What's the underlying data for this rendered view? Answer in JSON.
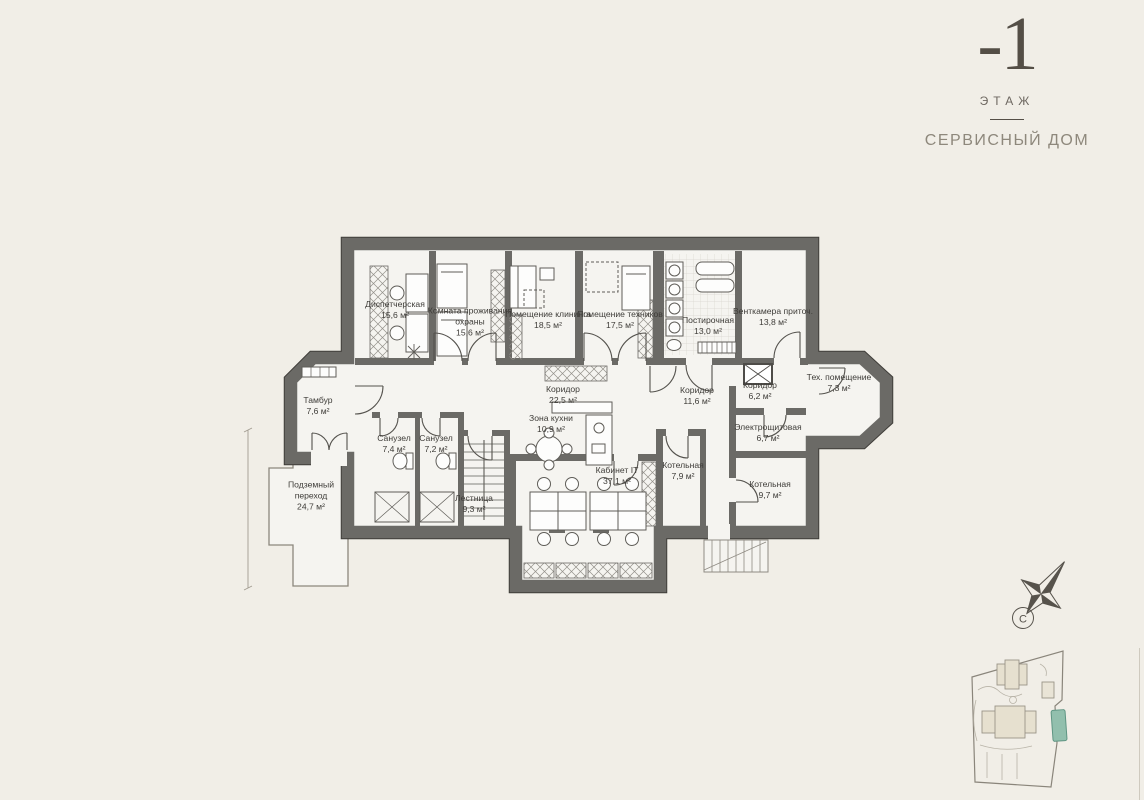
{
  "header": {
    "floor_number": "-1",
    "floor_label": "ЭТАЖ",
    "building_name": "СЕРВИСНЫЙ ДОМ"
  },
  "rooms": [
    {
      "name": "Диспетчерская",
      "area": "15,6 м²"
    },
    {
      "name": "Комната проживания охраны",
      "area": "15,6 м²"
    },
    {
      "name": "Помещение клининга",
      "area": "18,5 м²"
    },
    {
      "name": "Помещение техников",
      "area": "17,5 м²"
    },
    {
      "name": "Постирочная",
      "area": "13,0 м²"
    },
    {
      "name": "Венткамера приточ.",
      "area": "13,8 м²"
    },
    {
      "name": "Тамбур",
      "area": "7,6 м²"
    },
    {
      "name": "Коридор",
      "area": "22,5 м²"
    },
    {
      "name": "Зона кухни",
      "area": "10,9 м²"
    },
    {
      "name": "Коридор",
      "area": "11,6 м²"
    },
    {
      "name": "Коридор",
      "area": "6,2 м²"
    },
    {
      "name": "Тех. помещение",
      "area": "7,3 м²"
    },
    {
      "name": "Санузел",
      "area": "7,4 м²"
    },
    {
      "name": "Санузел",
      "area": "7,2 м²"
    },
    {
      "name": "Лестница",
      "area": "9,3 м²"
    },
    {
      "name": "Кабинет IT",
      "area": "37,1 м²"
    },
    {
      "name": "Котельная",
      "area": "7,9 м²"
    },
    {
      "name": "Электрощитовая",
      "area": "6,7 м²"
    },
    {
      "name": "Котельная",
      "area": "9,7 м²"
    },
    {
      "name": "Подземный переход",
      "area": "24,7 м²"
    }
  ],
  "compass": {
    "north": "С"
  },
  "site_map": {
    "highlighted_building": "СЕРВИСНЫЙ ДОМ",
    "highlight_color": "#92bfad"
  },
  "colors": {
    "background": "#f1eee7",
    "wall": "#6b6a66",
    "room_fill": "#f5f4f0"
  }
}
